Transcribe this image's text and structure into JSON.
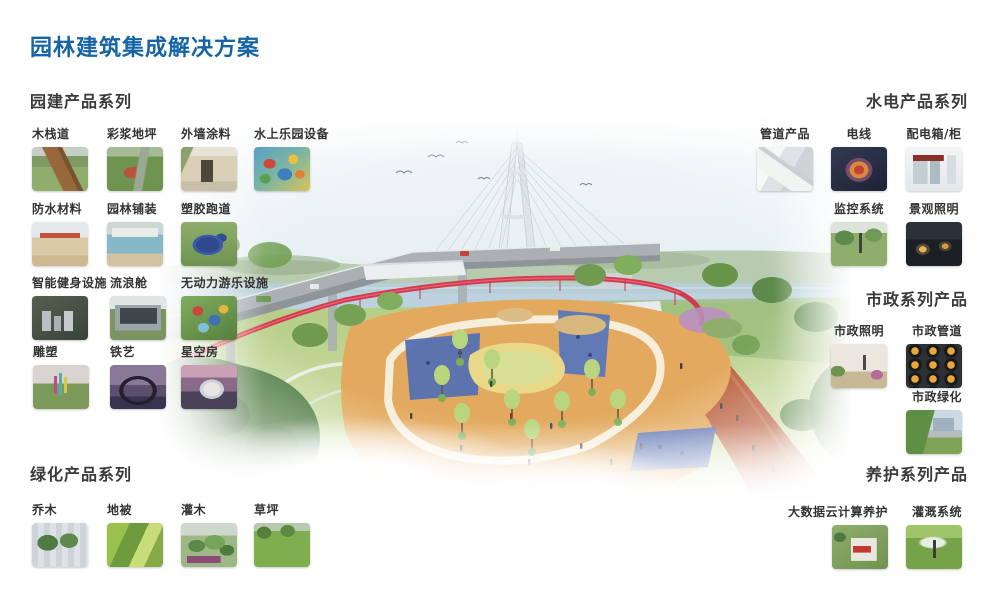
{
  "title": "园林建筑集成解决方案",
  "accent_color": "#1464a6",
  "sections": {
    "garden": {
      "heading": "园建产品系列",
      "items": [
        {
          "label": "木栈道"
        },
        {
          "label": "彩浆地坪"
        },
        {
          "label": "外墙涂料"
        },
        {
          "label": "水上乐园设备"
        },
        {
          "label": "防水材料"
        },
        {
          "label": "园林铺装"
        },
        {
          "label": "塑胶跑道"
        },
        {
          "label": "智能健身设施"
        },
        {
          "label": "流浪舱"
        },
        {
          "label": "无动力游乐设施"
        },
        {
          "label": "雕塑"
        },
        {
          "label": "铁艺"
        },
        {
          "label": "星空房"
        }
      ]
    },
    "hydro": {
      "heading": "水电产品系列",
      "items": [
        {
          "label": "管道产品"
        },
        {
          "label": "电线"
        },
        {
          "label": "配电箱/柜"
        },
        {
          "label": "监控系统"
        },
        {
          "label": "景观照明"
        }
      ]
    },
    "municipal": {
      "heading": "市政系列产品",
      "items": [
        {
          "label": "市政照明"
        },
        {
          "label": "市政管道"
        },
        {
          "label": "市政绿化"
        }
      ]
    },
    "greening": {
      "heading": "绿化产品系列",
      "items": [
        {
          "label": "乔木"
        },
        {
          "label": "地被"
        },
        {
          "label": "灌木"
        },
        {
          "label": "草坪"
        }
      ]
    },
    "maintenance": {
      "heading": "养护系列产品",
      "items": [
        {
          "label": "大数据云计算养护"
        },
        {
          "label": "灌溉系统"
        }
      ]
    }
  }
}
